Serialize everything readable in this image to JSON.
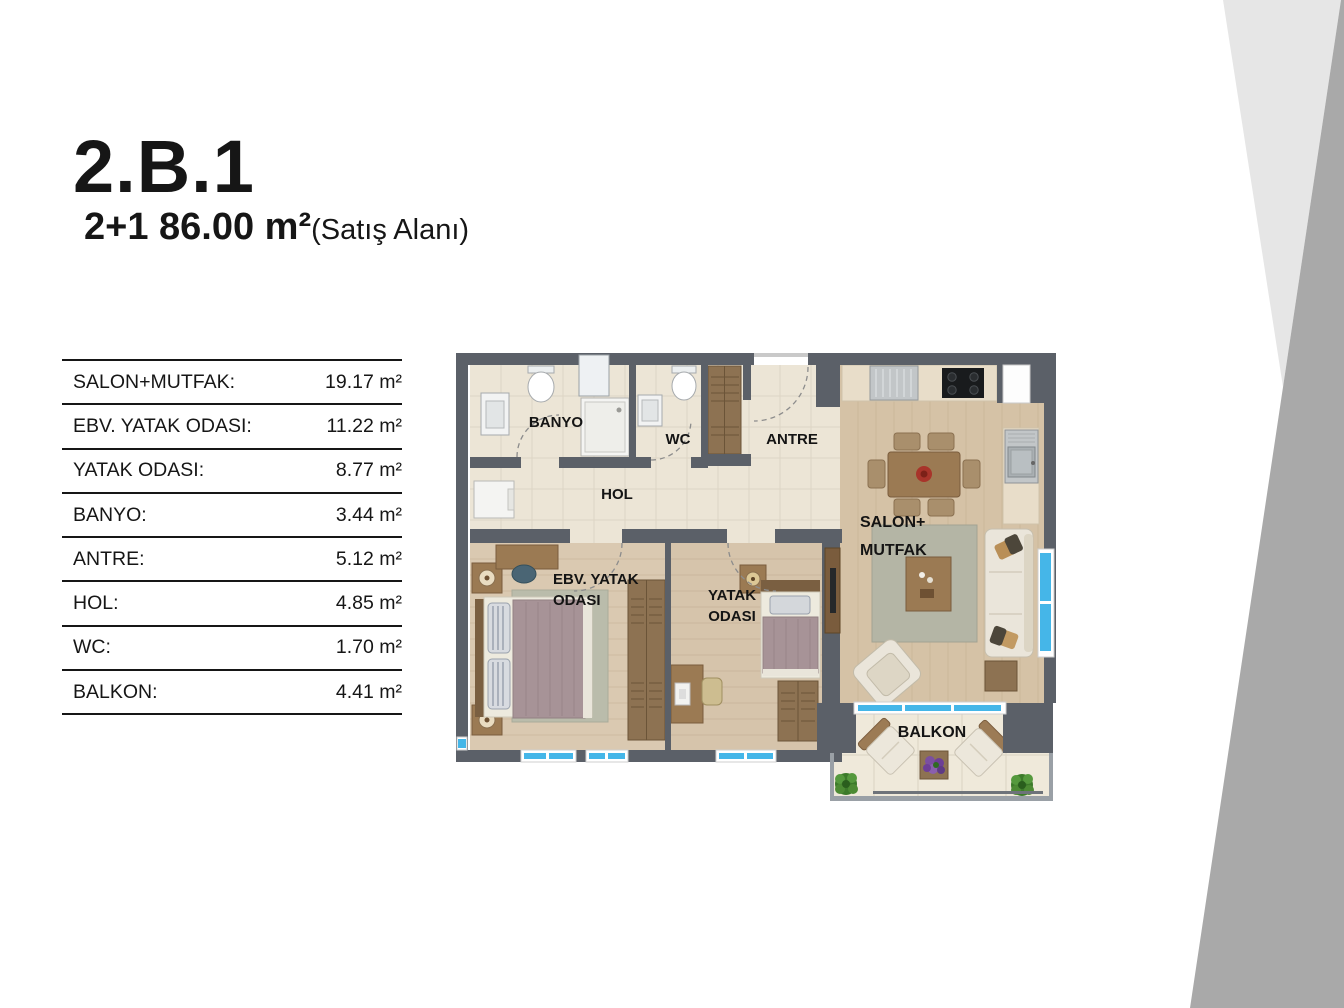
{
  "header": {
    "unit_code": "2.B.1",
    "unit_spec": "2+1 86.00 m²",
    "unit_spec_note": "(Satış Alanı)"
  },
  "area_table": {
    "rows": [
      {
        "label": "SALON+MUTFAK:",
        "value": "19.17 m²"
      },
      {
        "label": "EBV. YATAK ODASI:",
        "value": "11.22 m²"
      },
      {
        "label": "YATAK ODASI:",
        "value": "8.77 m²"
      },
      {
        "label": "BANYO:",
        "value": "3.44 m²"
      },
      {
        "label": "ANTRE:",
        "value": "5.12 m²"
      },
      {
        "label": "HOL:",
        "value": "4.85 m²"
      },
      {
        "label": "WC:",
        "value": "1.70 m²"
      },
      {
        "label": "BALKON:",
        "value": "4.41 m²"
      }
    ]
  },
  "floorplan": {
    "labels": {
      "banyo": "BANYO",
      "wc": "WC",
      "antre": "ANTRE",
      "hol": "HOL",
      "salon_line1": "SALON+",
      "salon_line2": "MUTFAK",
      "ebv_line1": "EBV. YATAK",
      "ebv_line2": "ODASI",
      "yatak_line1": "YATAK",
      "yatak_line2": "ODASI",
      "balkon": "BALKON"
    },
    "colors": {
      "wall": "#5b6068",
      "window_blue": "#45b6e8",
      "tile_floor": "#ece5d6",
      "salon_wood": "#d5c2a6",
      "bedroom_wood": "#dac9b1",
      "balcony_tile": "#efe9da"
    }
  },
  "decor": {
    "light_wedge": "#e6e6e6",
    "dark_band": "#a9a9a9"
  }
}
